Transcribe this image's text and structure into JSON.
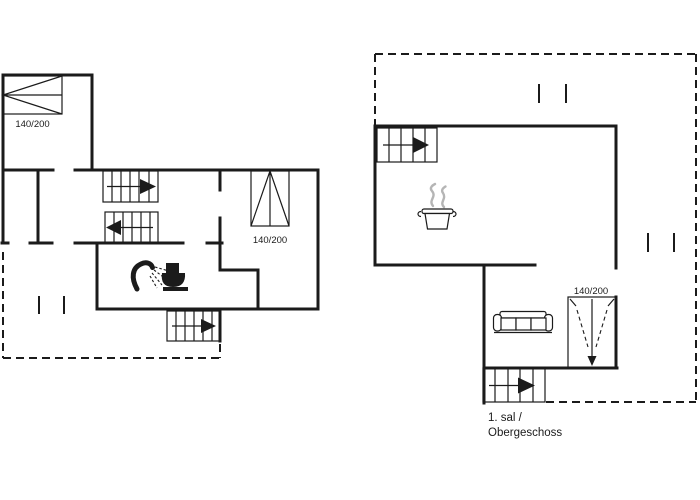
{
  "document": {
    "kind": "holiday-house floor plan, two storeys",
    "background_color": "#ffffff",
    "line_color": "#1b1b1b",
    "steam_color": "#b5b5b5"
  },
  "ground_floor": {
    "bed_label_top_left": "140/200",
    "bed_label_right_room": "140/200",
    "icons": [
      "double-bed",
      "double-bed",
      "staircase-arrow-right",
      "staircase-arrow-left",
      "staircase-arrow-right",
      "shower",
      "toilet",
      "terrace-dashed-outline",
      "railing-ticks"
    ]
  },
  "upper_floor": {
    "bed_label": "140/200",
    "caption_line1": "1. sal /",
    "caption_line2": "Obergeschoss",
    "icons": [
      "staircase-arrow-right",
      "cooking-pot-steam",
      "sofa",
      "double-bed-sloped-ceiling",
      "roof-dashed-outline",
      "vent-ticks",
      "staircase-arrow-right"
    ]
  }
}
